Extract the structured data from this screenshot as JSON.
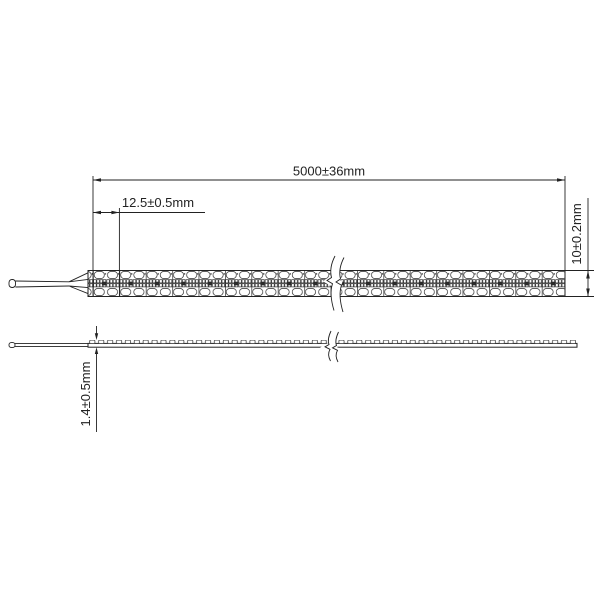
{
  "diagram": {
    "type": "technical-dimension-drawing",
    "subject": "led-strip-light",
    "dimensions": {
      "total_length": {
        "label": "5000±36mm"
      },
      "segment_pitch": {
        "label": "12.5±0.5mm"
      },
      "strip_width": {
        "label": "10±0.2mm"
      },
      "strip_thickness": {
        "label": "1.4±0.5mm"
      }
    },
    "colors": {
      "line": "#222222",
      "background": "#ffffff",
      "component_fill": "#2b2b2b"
    }
  }
}
